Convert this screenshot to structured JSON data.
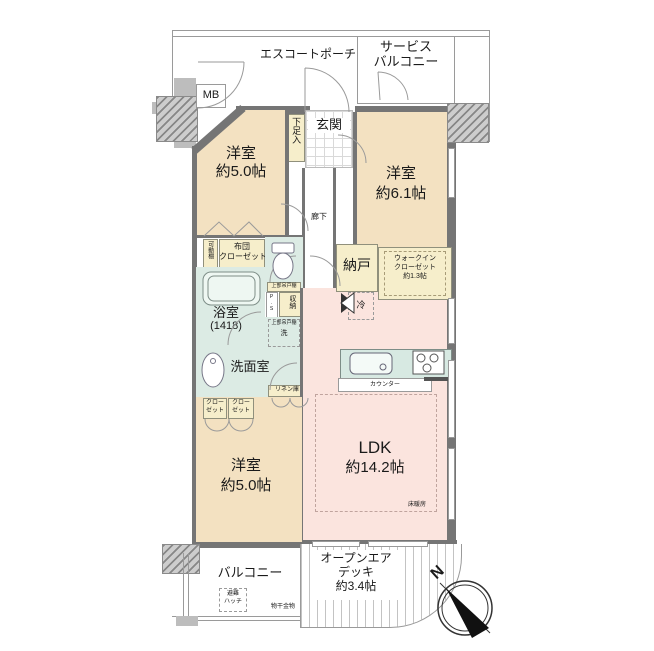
{
  "palette": {
    "room_tan": "#f3e1c1",
    "ldk_pink": "#fbe4de",
    "wet_aqua": "#dcebe4",
    "closet_cream": "#f6eecb",
    "wall_dark": "#757575",
    "wall_light": "#bdbdbd"
  },
  "plan": {
    "porch": "エスコートポーチ",
    "service_balcony": {
      "line1": "サービス",
      "line2": "バルコニー"
    },
    "mb": "MB",
    "shoe_box": "下足入",
    "genkan": "玄関",
    "corridor": "廊下",
    "bedroom_top_left": {
      "name": "洋室",
      "size": "約5.0帖"
    },
    "bedroom_top_right": {
      "name": "洋室",
      "size": "約6.1帖"
    },
    "movable_shelf": "可動棚",
    "futon_closet": {
      "line1": "布団",
      "line2": "クローゼット"
    },
    "toilet_upper_cabinet": "上部吊戸棚",
    "bath": {
      "name": "浴室",
      "size": "(1418)"
    },
    "ps": "P.S",
    "storage": "収納",
    "washer_upper_cabinet": "上部吊戸棚",
    "washer": "洗",
    "washroom": "洗面室",
    "linen": "リネン庫",
    "nando": "納戸",
    "wic": {
      "line1": "ウォークイン",
      "line2": "クローゼット",
      "line3": "約1.3帖"
    },
    "fridge": "冷",
    "ldk": {
      "name": "LDK",
      "size": "約14.2帖"
    },
    "counter": "カウンター",
    "floor_heating": "床暖房",
    "closet_a": {
      "line1": "クロー",
      "line2": "ゼット"
    },
    "closet_b": {
      "line1": "クロー",
      "line2": "ゼット"
    },
    "bedroom_bottom": {
      "name": "洋室",
      "size": "約5.0帖"
    },
    "balcony": "バルコニー",
    "escape_hatch": {
      "line1": "避難",
      "line2": "ハッチ"
    },
    "laundry_bracket": "物干金物",
    "deck": {
      "line1": "オープンエア",
      "line2": "デッキ",
      "line3": "約3.4帖"
    },
    "compass_north": "N"
  }
}
